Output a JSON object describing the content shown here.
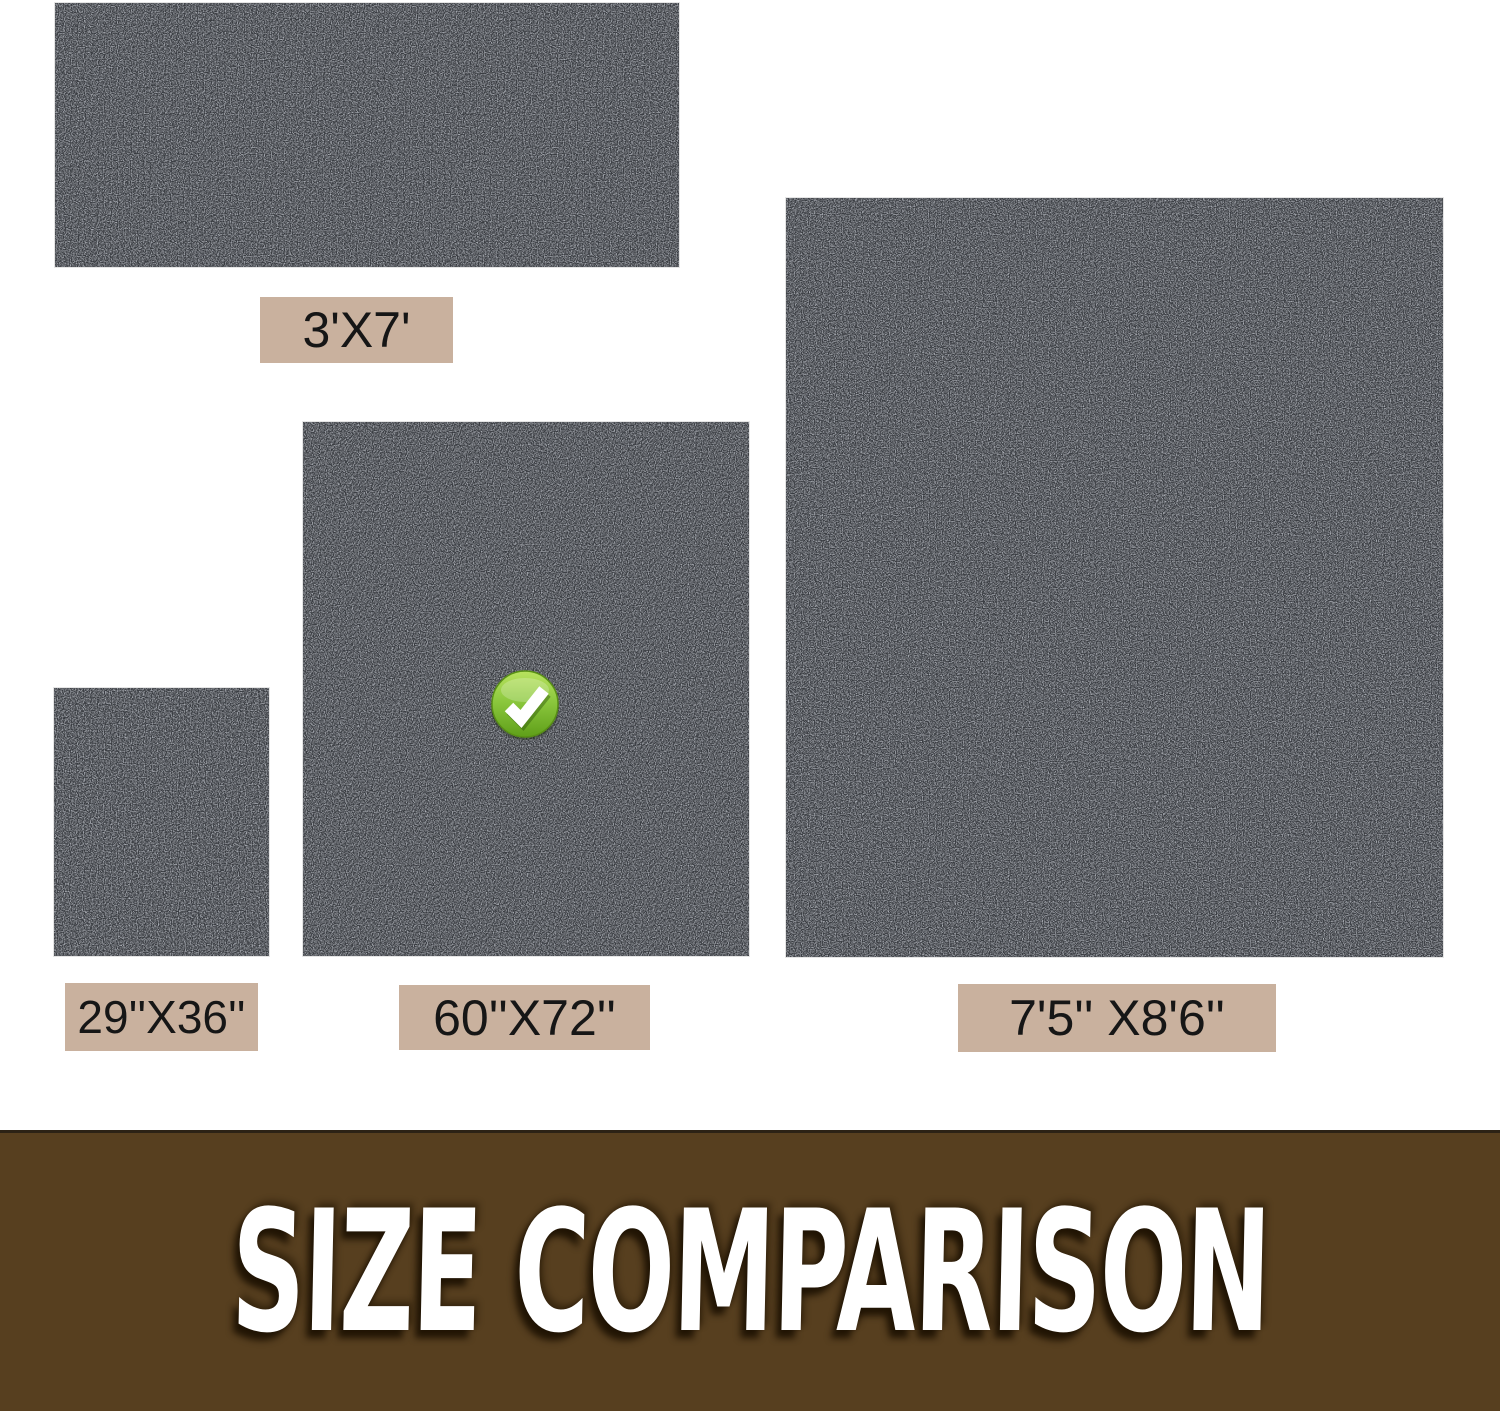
{
  "image": {
    "kind": "product-size-comparison-graphic",
    "background": "#ffffff"
  },
  "sizes": {
    "s3x7": {
      "label": "3'X7'",
      "selected": false
    },
    "s29x36": {
      "label": "29''X36''",
      "selected": false
    },
    "s60x72": {
      "label": "60''X72''",
      "selected": true
    },
    "s75x86": {
      "label": "7'5'' X8'6''",
      "selected": false
    }
  },
  "selected_size": "60''X72''",
  "icons": {
    "check": "check-icon"
  },
  "banner": {
    "title": "SIZE COMPARISON"
  },
  "colors": {
    "mat_base": "#383b41",
    "mat_rim": "#24272c",
    "label_background": "#c9b19e",
    "label_text": "#161616",
    "banner_background": "#573f1f",
    "banner_text": "#ffffff",
    "check_green": "#76b82a"
  }
}
